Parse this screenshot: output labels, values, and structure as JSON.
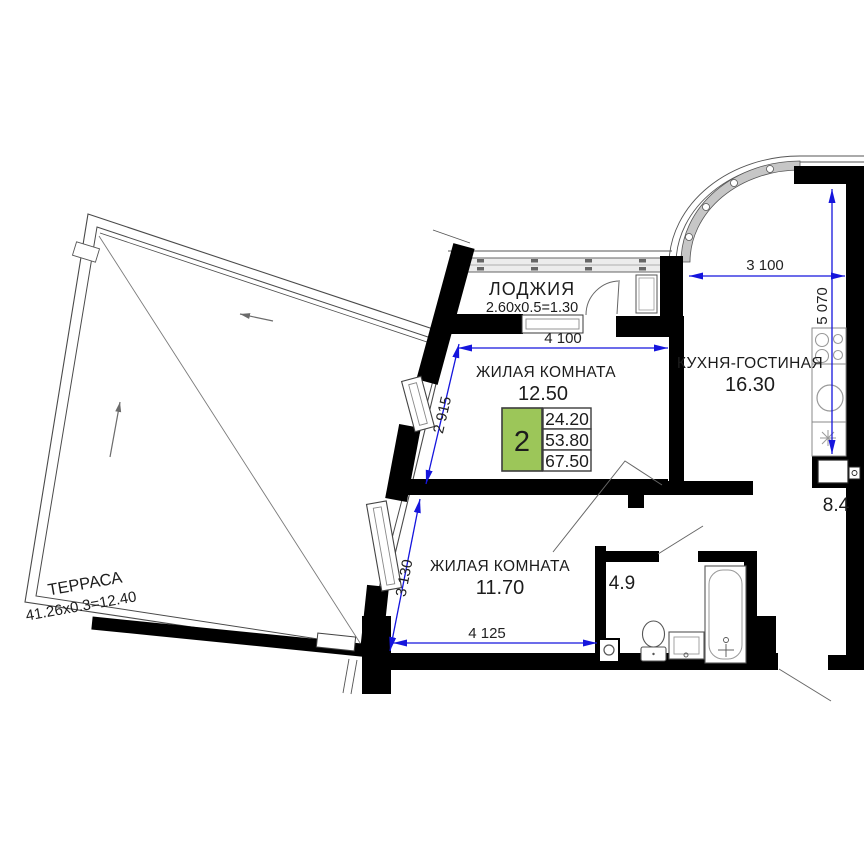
{
  "plan_title": "2-room apartment floor plan",
  "rooms": {
    "loggia": {
      "name": "ЛОДЖИЯ",
      "size_formula": "2.60x0.5=1.30"
    },
    "living_room_1": {
      "name": "ЖИЛАЯ КОМНАТА",
      "area": "12.50"
    },
    "kitchen_living": {
      "name": "КУХНЯ-ГОСТИНАЯ",
      "area": "16.30"
    },
    "living_room_2": {
      "name": "ЖИЛАЯ КОМНАТА",
      "area": "11.70"
    },
    "bathroom": {
      "area": "4.9"
    },
    "hallway": {
      "area": "8.4"
    },
    "terrace": {
      "name": "ТЕРРАСА",
      "size_formula": "41.26x0.3=12.40"
    }
  },
  "summary_table": {
    "rooms_count": "2",
    "living_area": "24.20",
    "apartment_area": "53.80",
    "total_area": "67.50"
  },
  "dimensions": {
    "kitchen_width": "3 100",
    "kitchen_depth": "5 070",
    "living1_width": "4 100",
    "living1_depth": "2 915",
    "living2_depth": "3 130",
    "living2_width": "4 125"
  },
  "colors": {
    "wall": "#000000",
    "dimension_line": "#1515dd",
    "table_green": "#9cc659",
    "thin_line": "#555555"
  }
}
